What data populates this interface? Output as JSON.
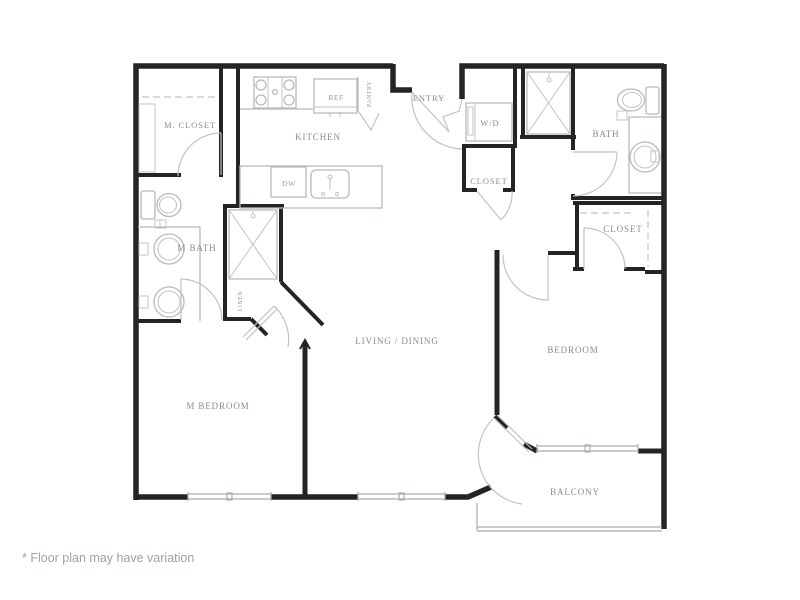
{
  "colors": {
    "background": "#ffffff",
    "wall": "#242424",
    "fixture_gray": "#b7bbbb",
    "label_gray": "#8c8c84",
    "footnote_gray": "#9aa4a5"
  },
  "floorplan": {
    "rooms": {
      "m_closet": "M. CLOSET",
      "kitchen": "KITCHEN",
      "entry": "ENTRY",
      "wd": "W/D",
      "bath": "BATH",
      "hall_closet": "CLOSET",
      "bedroom_closet": "CLOSET",
      "m_bath": "M BATH",
      "linen": "LINEN",
      "living_dining": "LIVING / DINING",
      "m_bedroom": "M BEDROOM",
      "bedroom": "BEDROOM",
      "balcony": "BALCONY"
    },
    "appliances": {
      "ref": "REF",
      "pantry": "PANTRY",
      "dw": "DW"
    },
    "footnote": "* Floor plan may have variation"
  }
}
